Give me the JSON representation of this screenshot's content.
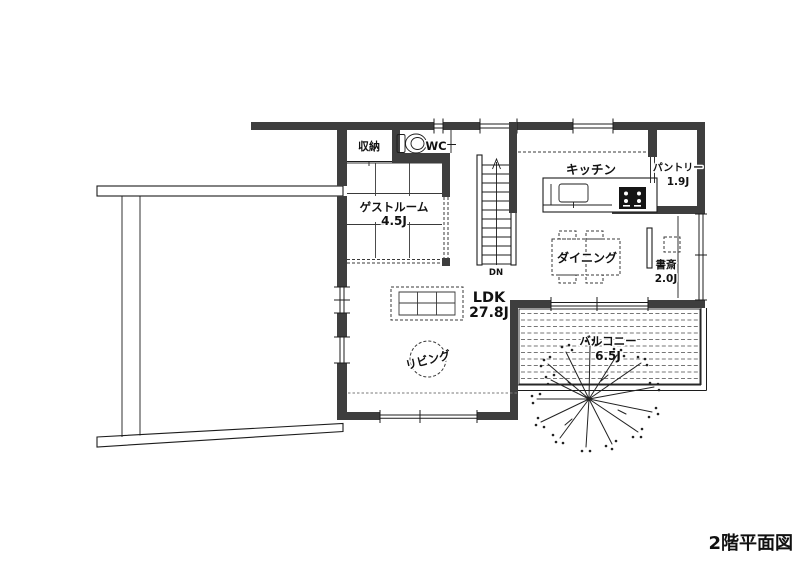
{
  "title": "2階平面図",
  "colors": {
    "wall": "#3e3e3e",
    "line": "#1c1c1c",
    "background": "#ffffff"
  },
  "rooms": {
    "storage": {
      "label": "収納"
    },
    "wc": {
      "label": "WC"
    },
    "guest_room": {
      "label": "ゲストルーム",
      "size": "4.5J"
    },
    "kitchen": {
      "label": "キッチン"
    },
    "pantry": {
      "label": "パントリー",
      "size": "1.9J"
    },
    "dining": {
      "label": "ダイニング"
    },
    "study": {
      "label": "書斎",
      "size": "2.0J"
    },
    "ldk": {
      "label": "LDK",
      "size": "27.8J"
    },
    "living": {
      "label": "リビング"
    },
    "balcony": {
      "label": "バルコニー",
      "size": "6.5J"
    }
  },
  "stairs": {
    "label": "DN"
  }
}
